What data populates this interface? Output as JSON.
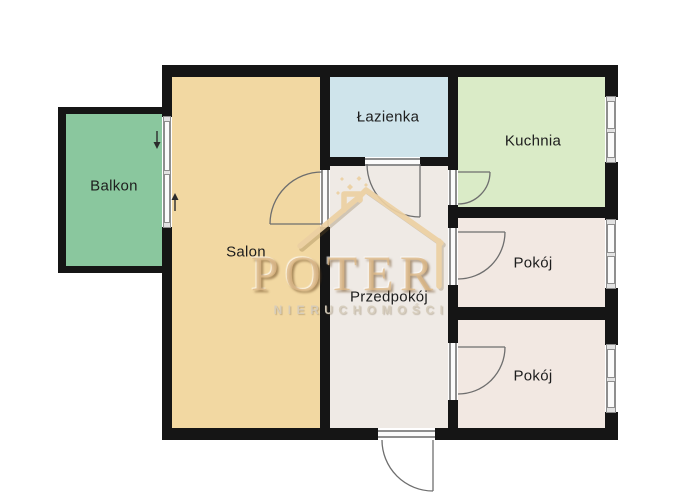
{
  "plan": {
    "rooms": {
      "balkon": {
        "label": "Balkon",
        "color": "#8ac79e"
      },
      "salon": {
        "label": "Salon",
        "color": "#f2d8a2"
      },
      "lazienka": {
        "label": "Łazienka",
        "color": "#cfe4eb"
      },
      "kuchnia": {
        "label": "Kuchnia",
        "color": "#daebc7"
      },
      "przedpokoj": {
        "label": "Przedpokój",
        "color": "#efeae5"
      },
      "pokoj1": {
        "label": "Pokój",
        "color": "#f2e8e2"
      },
      "pokoj2": {
        "label": "Pokój",
        "color": "#f2e8e2"
      }
    },
    "colors": {
      "wall": "#151515",
      "background": "#ffffff",
      "door_stroke": "#6e6e6e",
      "watermark_tan": "#ecd0a2",
      "watermark_text": "#deb887",
      "watermark_subtitle": "#d6ccbc"
    }
  },
  "watermark": {
    "brand": "POTER",
    "subtitle": "NIERUCHOMOŚCI"
  }
}
